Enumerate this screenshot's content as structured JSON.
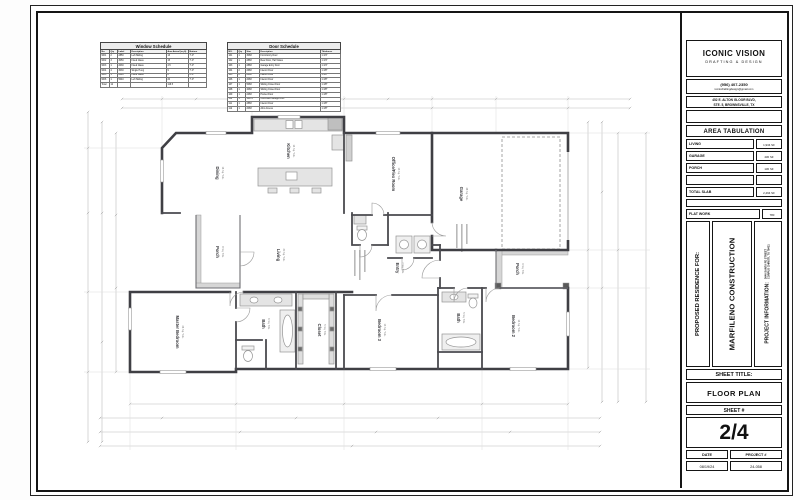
{
  "title_block": {
    "company": "ICONIC VISION",
    "company_sub": "DRAFTING & DESIGN",
    "phone": "(956) 407-2350",
    "email": "iconicdraftingdesign@gmail.com",
    "address_line1": "452 E. ALTON GLOOR BLVD,",
    "address_line2": "STE. 5, BROWNSVILLE, TX",
    "area_tabulation": {
      "title": "AREA TABULATION",
      "living_label": "LIVING",
      "living_value": "1,934 SF",
      "garage_label": "GARAGE",
      "garage_value": "430 SF",
      "porch_label": "PORCH",
      "porch_value": "130 SF",
      "total_label": "TOTAL SLAB",
      "total_value": "2,494 SF",
      "flat_work_label": "FLAT WORK",
      "flat_work_value": "780"
    },
    "proposed_for": "PROPOSED RESIDENCE FOR:",
    "client": "MARFILENO CONSTRUCTION",
    "project_info_label": "PROJECT INFORMATION:",
    "project_address_line1": "3646 SANTA FE STREET",
    "project_address_line2": "CORPUS CHRISTI, TX 78411",
    "sheet_title_label": "SHEET TITLE:",
    "sheet_title": "FLOOR PLAN",
    "sheet_number_label": "SHEET #",
    "sheet_number": "2/4",
    "date_label": "DATE",
    "date_value": "08/19/24",
    "project_number_label": "PROJECT #",
    "project_number_value": "24-058"
  },
  "window_schedule": {
    "title": "Window Schedule",
    "headers": [
      "No.",
      "Qty",
      "Label",
      "Description",
      "Area Actual (sq ft)",
      "Bottom"
    ],
    "rows": [
      [
        "W01",
        "2",
        "2850",
        "Left Sliding",
        "13",
        "7'-0\""
      ],
      [
        "W02",
        "3",
        "3050",
        "Fixed Glass",
        "15",
        "7'-0\""
      ],
      [
        "W03",
        "1",
        "2030",
        "Fixed Glass",
        "4.5",
        "7'-0\""
      ],
      [
        "W04",
        "4",
        "3030",
        "Single Hung",
        "9",
        "7'-0\""
      ],
      [
        "W05",
        "1",
        "2040",
        "Fixed Glass",
        "8",
        "6'-8\""
      ],
      [
        "W06",
        "1",
        "5040",
        "Left Sliding",
        "20",
        "7'-0\""
      ],
      [
        "Total",
        "12",
        "",
        "",
        "116.5",
        ""
      ]
    ]
  },
  "door_schedule": {
    "title": "Door Schedule",
    "headers": [
      "NO.",
      "Qty",
      "Size",
      "Description",
      "Thickness"
    ],
    "rows": [
      [
        "101",
        "1",
        "3068",
        "Front Entry Door",
        "1 3/4\""
      ],
      [
        "102",
        "1",
        "2868",
        "Rear Door, Half Glass",
        "1 3/4\""
      ],
      [
        "103",
        "1",
        "2868",
        "Garage Entry Door",
        "1 3/4\""
      ],
      [
        "104",
        "2",
        "2668",
        "Interior Door",
        "1 3/8\""
      ],
      [
        "105",
        "2",
        "2468",
        "Interior Door",
        "1 3/8\""
      ],
      [
        "106",
        "1",
        "2068",
        "Interior Door",
        "1 3/8\""
      ],
      [
        "107",
        "1",
        "5068",
        "Sliding Closet Door",
        "1 3/8\""
      ],
      [
        "108",
        "1",
        "4068",
        "Sliding Closet Door",
        "1 3/8\""
      ],
      [
        "109",
        "1",
        "2468",
        "Pocket Door",
        "1 3/8\""
      ],
      [
        "110",
        "1",
        "16070",
        "Overhead Garage Door",
        ""
      ],
      [
        "111",
        "1",
        "2868",
        "Interior Door",
        "1 3/8\""
      ],
      [
        "112",
        "1",
        "2068",
        "Attic Access",
        "1 3/8\""
      ]
    ]
  },
  "rooms": [
    {
      "name": "Dining",
      "area": "16 Sq. Yds."
    },
    {
      "name": "Kitchen",
      "area": "14 Sq. Yds."
    },
    {
      "name": "Office/Flex Room",
      "area": "13 Sq. Yds."
    },
    {
      "name": "Garage",
      "area": "48 Sq. Yds."
    },
    {
      "name": "Living",
      "area": "30 Sq. Yds."
    },
    {
      "name": "Porch",
      "area": "8 Sq. Yds."
    },
    {
      "name": "Entry",
      "area": "7 Sq. Yds."
    },
    {
      "name": "Porch",
      "area": "9 Sq. Yds."
    },
    {
      "name": "Master Bedroom",
      "area": "26 Sq. Yds."
    },
    {
      "name": "Bath",
      "area": "6 Sq. Yds."
    },
    {
      "name": "Closet",
      "area": "5 Sq. Yds."
    },
    {
      "name": "Bedroom 3",
      "area": "13 Sq. Yds."
    },
    {
      "name": "Bath",
      "area": "5 Sq. Yds."
    },
    {
      "name": "Bedroom 2",
      "area": "14 Sq. Yds."
    }
  ]
}
